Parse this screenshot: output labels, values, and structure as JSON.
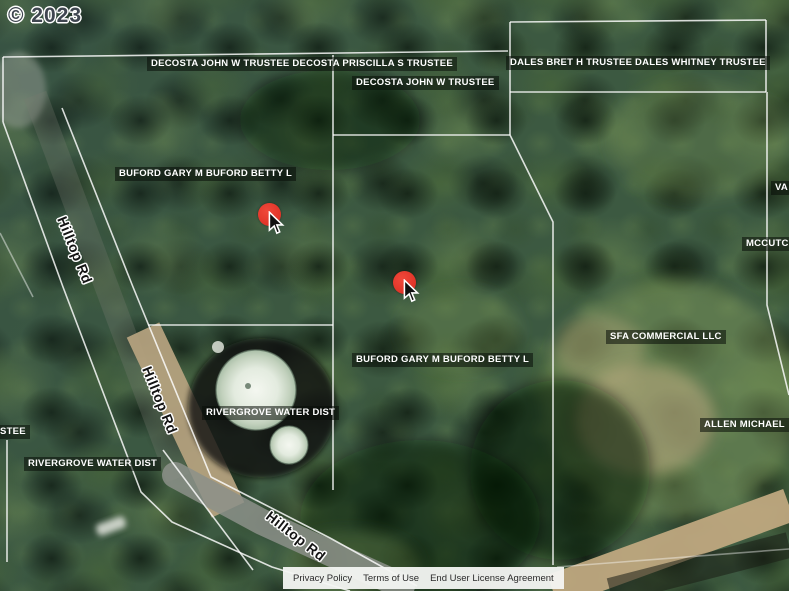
{
  "copyright": "© 2023",
  "parcel_labels": {
    "decosta_both": "DECOSTA JOHN W TRUSTEE DECOSTA PRISCILLA S TRUSTEE",
    "decosta_john": "DECOSTA JOHN W TRUSTEE",
    "dales": "DALES BRET H TRUSTEE DALES WHITNEY TRUSTEE",
    "buford_upper": "BUFORD GARY M BUFORD BETTY L",
    "buford_lower": "BUFORD GARY M BUFORD BETTY L",
    "rivergrove_tank": "RIVERGROVE WATER DIST",
    "rivergrove_west": "RIVERGROVE WATER DIST",
    "sfa": "SFA COMMERCIAL LLC",
    "allen": "ALLEN MICHAEL",
    "mccutcheon_clipped": "MCCUTC",
    "va_clipped": "VA",
    "trustee_clipped": "STEE"
  },
  "road_labels": {
    "hilltop_1": "Hilltop Rd",
    "hilltop_2": "Hilltop Rd",
    "hilltop_3": "Hilltop Rd"
  },
  "markers": {
    "count": 2,
    "color": "#e8392e"
  },
  "footer": {
    "links": [
      {
        "label": "Privacy Policy"
      },
      {
        "label": "Terms of Use"
      },
      {
        "label": "End User License Agreement"
      }
    ]
  },
  "colors": {
    "marker_red": "#e8392e",
    "boundary_white": "#ffffff",
    "label_bg": "rgba(8,12,8,0.55)",
    "footer_bg": "#f4f5f3",
    "forest_base": "#3c5941",
    "dirt_road": "#b4a17e",
    "paved_road": "#8c9089",
    "tank_white": "#eef3ea"
  }
}
